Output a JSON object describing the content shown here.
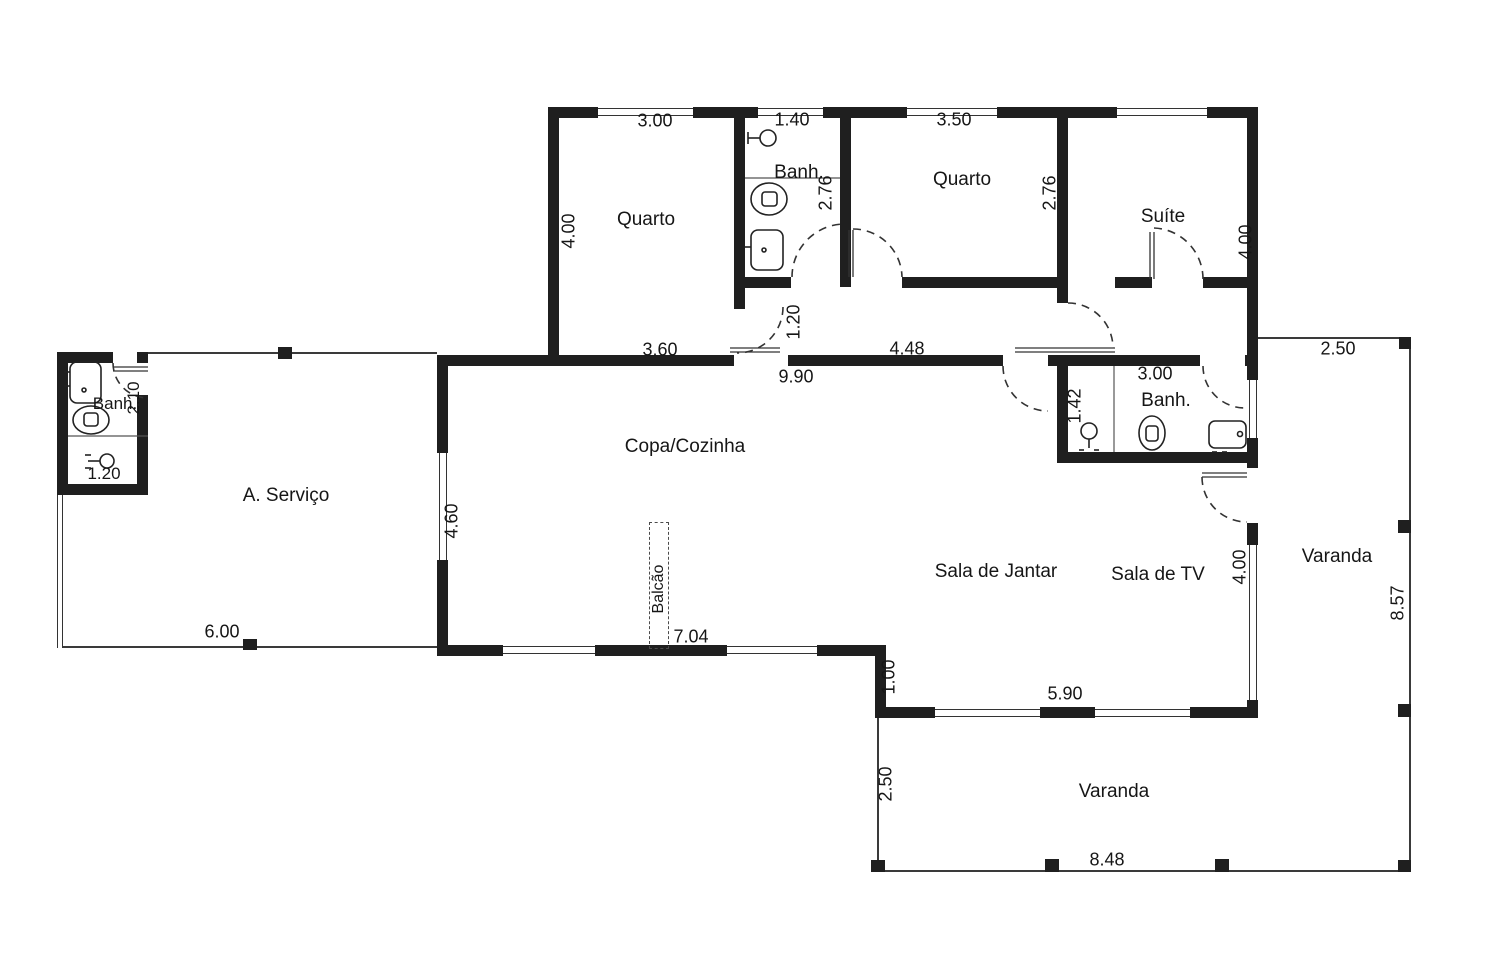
{
  "plan": {
    "type": "residential-floor-plan",
    "labels": {
      "quarto1": "Quarto",
      "quarto2": "Quarto",
      "suite": "Suíte",
      "banh_top": "Banh.",
      "banh_suite": "Banh.",
      "banh_servico": "Banh.",
      "servico": "A. Serviço",
      "copa": "Copa/Cozinha",
      "balcao": "Balcão",
      "sala_jantar": "Sala de Jantar",
      "sala_tv": "Sala de TV",
      "varanda_sul": "Varanda",
      "varanda_leste": "Varanda"
    },
    "dims": {
      "quarto1_w": "3.00",
      "banh_top_w": "1.40",
      "quarto2_w": "3.50",
      "quarto1_h": "4.00",
      "banh_top_h": "2.76",
      "quarto2_h": "2.76",
      "suite_h": "4.00",
      "hall_q1_w": "3.60",
      "hall_door_w": "1.20",
      "hall_q2_w": "4.48",
      "copa_w": "9.90",
      "varanda_leste_topo": "2.50",
      "banh_suite_w": "3.00",
      "banh_suite_box": "1.42",
      "banh_serv_h": "2.10",
      "banh_serv_box": "1.20",
      "copa_janela_h": "4.60",
      "servico_w": "6.00",
      "copa_baixo_w": "7.04",
      "degrau_h": "1.00",
      "sala_baixo_w": "5.90",
      "sala_tv_h": "4.00",
      "varanda_sul_h": "2.50",
      "varanda_sul_w": "8.48",
      "varanda_leste_h": "8.57"
    },
    "icons": [
      "toilet-icon",
      "sink-icon",
      "shower-icon",
      "door-arc",
      "column"
    ],
    "colors": {
      "wall": "#1f1f1f",
      "line": "#3a3a3a",
      "text": "#161616",
      "background": "#ffffff"
    }
  }
}
